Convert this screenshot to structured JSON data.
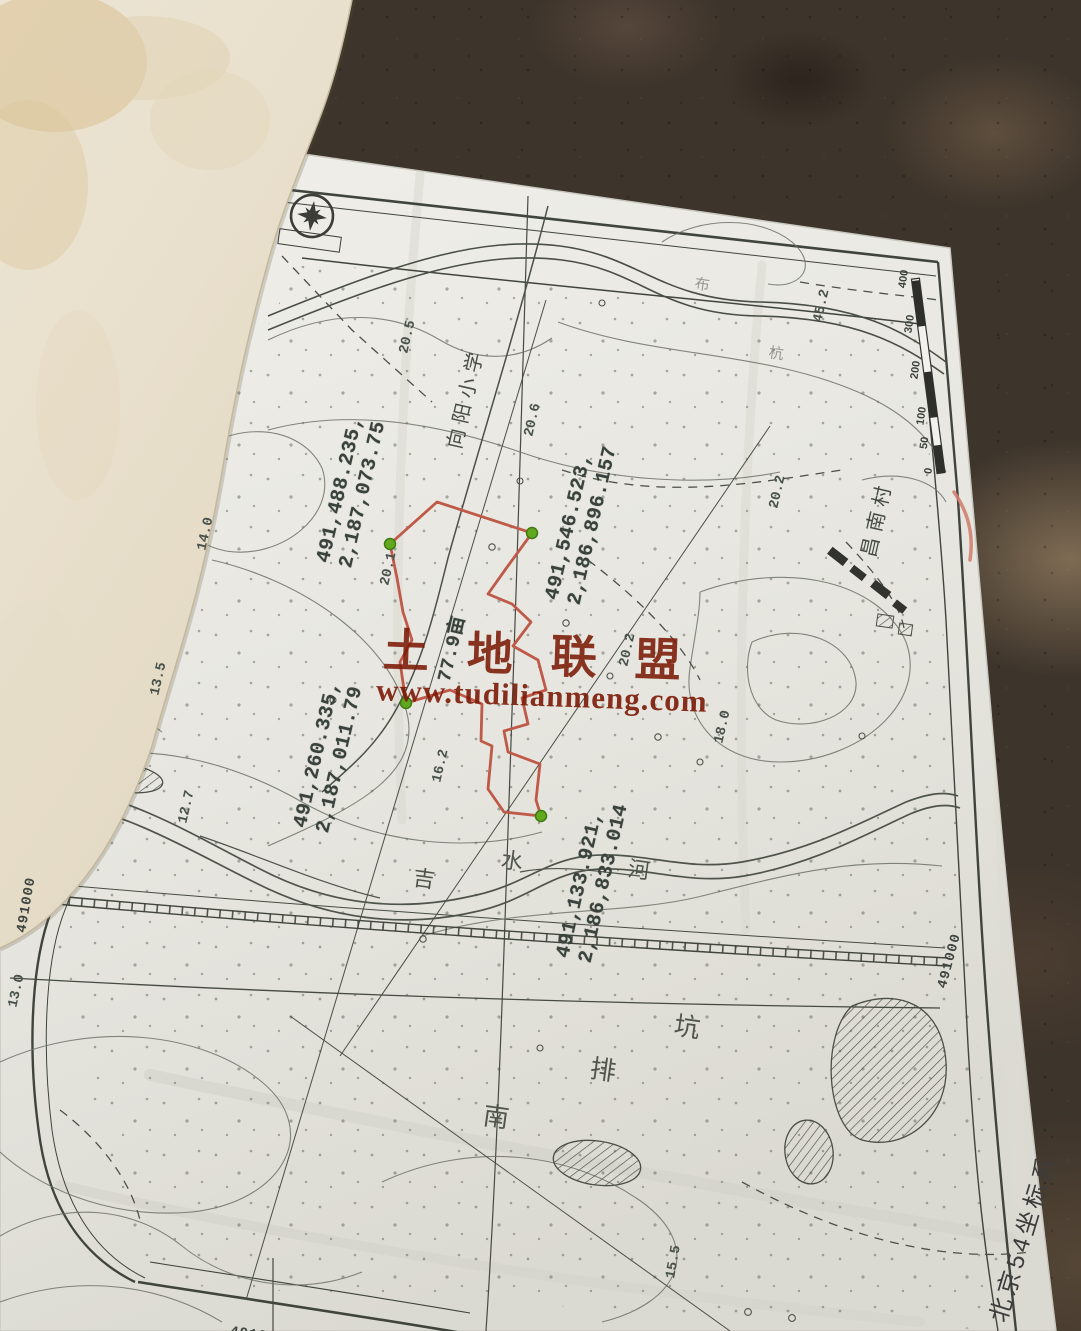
{
  "watermark": {
    "title": "土地联盟",
    "url": "www.tudilianmeng.com"
  },
  "colors": {
    "parcel_outline": "#bf5a49",
    "parcel_vertex": "#61a81f",
    "parcel_vertex_edge": "#3f7a12",
    "watermark": "#7c1a06",
    "coordinate_text": "#39423c",
    "map_line": "#4a4f46",
    "pen_mark": "#d08171",
    "paper": "#e9e8e3"
  },
  "parcel": {
    "area_label": "77.9亩",
    "vertex_coordinates": [
      "491,488.235, 2,187,073.75",
      "491,546.523, 2,186,896.157",
      "491,260.335, 2,187,011.79",
      "491,133.921, 2,186,833.014"
    ]
  },
  "map": {
    "coordinate_system": "北京54坐标系",
    "grid_labels": [
      "491000",
      "491000",
      "491000"
    ],
    "place_names": [
      "向阳小学",
      "昌南村",
      "吉水河",
      "南排坑"
    ],
    "spot_elevations": [
      "20.5",
      "20.6",
      "20.2",
      "45.2",
      "20.1",
      "14.0",
      "13.5",
      "12.7",
      "16.2",
      "20.2",
      "18.0",
      "13.0",
      "15.5"
    ],
    "scale_bar_labels": [
      "0",
      "50",
      "100",
      "200",
      "300",
      "400"
    ]
  },
  "annotations": [
    {
      "name": "parcel-vertex-coords-1",
      "cls": "coord",
      "x": 352,
      "y": 492,
      "rot": -77,
      "lines": [
        "491,488.235,",
        "2,187,073.75"
      ]
    },
    {
      "name": "parcel-vertex-coords-2",
      "cls": "coord",
      "x": 582,
      "y": 523,
      "rot": -77,
      "lines": [
        "491,546.523,",
        "2,186,896.157"
      ]
    },
    {
      "name": "parcel-vertex-coords-3",
      "cls": "coord",
      "x": 329,
      "y": 757,
      "rot": -77,
      "lines": [
        "491,260.335,",
        "2,187,011.79"
      ]
    },
    {
      "name": "parcel-vertex-coords-4",
      "cls": "coord",
      "x": 593,
      "y": 881,
      "rot": -77,
      "lines": [
        "491,133.921,",
        "2,186,833.014"
      ]
    },
    {
      "name": "parcel-area-label",
      "cls": "coord area",
      "x": 453,
      "y": 649,
      "rot": -77,
      "lines": [
        "77.9亩"
      ]
    },
    {
      "name": "spot-elevation",
      "cls": "elev",
      "x": 408,
      "y": 337,
      "rot": -77,
      "lines": [
        "20.5"
      ]
    },
    {
      "name": "spot-elevation",
      "cls": "elev",
      "x": 533,
      "y": 420,
      "rot": -77,
      "lines": [
        "20.6"
      ]
    },
    {
      "name": "spot-elevation",
      "cls": "elev",
      "x": 778,
      "y": 492,
      "rot": -77,
      "lines": [
        "20.2"
      ]
    },
    {
      "name": "spot-elevation",
      "cls": "elev",
      "x": 822,
      "y": 306,
      "rot": -77,
      "lines": [
        "45.2"
      ]
    },
    {
      "name": "spot-elevation",
      "cls": "elev",
      "x": 389,
      "y": 569,
      "rot": -77,
      "lines": [
        "20.1"
      ]
    },
    {
      "name": "spot-elevation",
      "cls": "elev",
      "x": 206,
      "y": 534,
      "rot": -77,
      "lines": [
        "14.0"
      ]
    },
    {
      "name": "spot-elevation",
      "cls": "elev",
      "x": 159,
      "y": 679,
      "rot": -77,
      "lines": [
        "13.5"
      ]
    },
    {
      "name": "spot-elevation",
      "cls": "elev",
      "x": 187,
      "y": 807,
      "rot": -77,
      "lines": [
        "12.7"
      ]
    },
    {
      "name": "spot-elevation",
      "cls": "elev",
      "x": 441,
      "y": 766,
      "rot": -77,
      "lines": [
        "16.2"
      ]
    },
    {
      "name": "spot-elevation",
      "cls": "elev",
      "x": 628,
      "y": 650,
      "rot": -77,
      "lines": [
        "20.2"
      ]
    },
    {
      "name": "spot-elevation",
      "cls": "elev",
      "x": 723,
      "y": 727,
      "rot": -77,
      "lines": [
        "18.0"
      ]
    },
    {
      "name": "spot-elevation",
      "cls": "elev",
      "x": 17,
      "y": 991,
      "rot": -77,
      "lines": [
        "13.0"
      ]
    },
    {
      "name": "spot-elevation",
      "cls": "elev",
      "x": 674,
      "y": 1262,
      "rot": -80,
      "lines": [
        "15.5"
      ]
    },
    {
      "name": "grid-label-left",
      "cls": "grid",
      "x": 27,
      "y": 905,
      "rot": -80,
      "lines": [
        "491000"
      ]
    },
    {
      "name": "grid-label-right",
      "cls": "grid",
      "x": 950,
      "y": 961,
      "rot": -75,
      "lines": [
        "491000"
      ]
    },
    {
      "name": "grid-label-bottom",
      "cls": "grid",
      "x": 258,
      "y": 1336,
      "rot": 8,
      "lines": [
        "491000"
      ]
    },
    {
      "name": "coordinate-system-label",
      "cls": "cs",
      "x": 1024,
      "y": 1238,
      "rot": -73,
      "lines": [
        "北京54坐标系"
      ]
    },
    {
      "name": "place-label-school",
      "cls": "place",
      "x": 467,
      "y": 398,
      "rot": -77,
      "lines": [
        "向阳小学"
      ]
    },
    {
      "name": "place-label-village",
      "cls": "place",
      "x": 878,
      "y": 519,
      "rot": -77,
      "lines": [
        "昌南村"
      ]
    },
    {
      "name": "river-name-char",
      "cls": "han",
      "x": 424,
      "y": 879,
      "rot": 8,
      "lines": [
        "吉"
      ]
    },
    {
      "name": "river-name-char",
      "cls": "han",
      "x": 512,
      "y": 861,
      "rot": 8,
      "lines": [
        "水"
      ]
    },
    {
      "name": "river-name-char",
      "cls": "han",
      "x": 639,
      "y": 870,
      "rot": 8,
      "lines": [
        "河"
      ]
    },
    {
      "name": "drain-name-char",
      "cls": "han big",
      "x": 497,
      "y": 1118,
      "rot": 8,
      "lines": [
        "南"
      ]
    },
    {
      "name": "drain-name-char",
      "cls": "han big",
      "x": 604,
      "y": 1071,
      "rot": 8,
      "lines": [
        "排"
      ]
    },
    {
      "name": "drain-name-char",
      "cls": "han big",
      "x": 688,
      "y": 1028,
      "rot": 8,
      "lines": [
        "坑"
      ]
    },
    {
      "name": "faint-place-char",
      "cls": "han faint",
      "x": 702,
      "y": 286,
      "rot": 8,
      "lines": [
        "布"
      ]
    },
    {
      "name": "faint-place-char",
      "cls": "han faint",
      "x": 776,
      "y": 355,
      "rot": 8,
      "lines": [
        "杭"
      ]
    },
    {
      "name": "scale-label",
      "cls": "scale",
      "x": 929,
      "y": 471,
      "rot": -82,
      "lines": [
        "0"
      ]
    },
    {
      "name": "scale-label",
      "cls": "scale",
      "x": 925,
      "y": 443,
      "rot": -82,
      "lines": [
        "50"
      ]
    },
    {
      "name": "scale-label",
      "cls": "scale",
      "x": 922,
      "y": 416,
      "rot": -82,
      "lines": [
        "100"
      ]
    },
    {
      "name": "scale-label",
      "cls": "scale",
      "x": 916,
      "y": 370,
      "rot": -82,
      "lines": [
        "200"
      ]
    },
    {
      "name": "scale-label",
      "cls": "scale",
      "x": 910,
      "y": 324,
      "rot": -82,
      "lines": [
        "300"
      ]
    },
    {
      "name": "scale-label",
      "cls": "scale",
      "x": 904,
      "y": 279,
      "rot": -82,
      "lines": [
        "400"
      ]
    }
  ]
}
